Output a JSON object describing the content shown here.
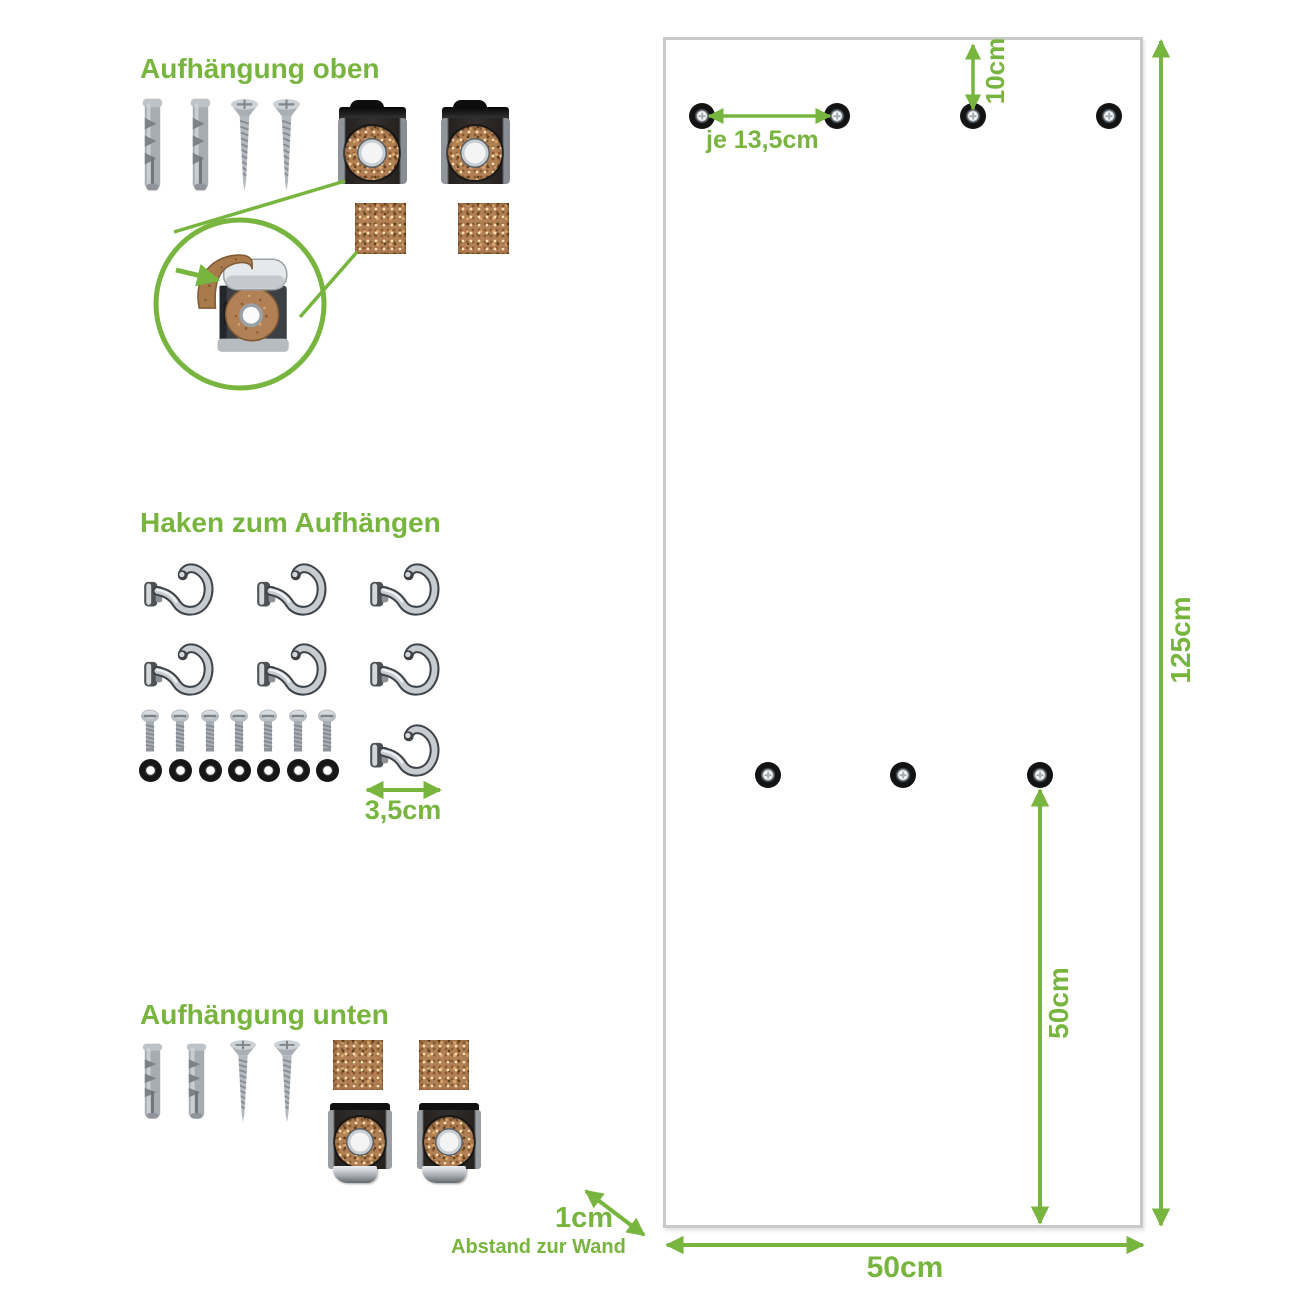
{
  "colors": {
    "accent_green": "#78b53f",
    "panel_border": "#c9c9c9",
    "cork": "#b28055",
    "metal_dark": "#2b2927",
    "chrome": "#c7ccd1"
  },
  "sections": {
    "hanging_top": {
      "title": "Aufhängung oben"
    },
    "hooks": {
      "title": "Haken zum Aufhängen",
      "hook_size": "3,5cm"
    },
    "hanging_bottom": {
      "title": "Aufhängung unten"
    }
  },
  "panel": {
    "dimensions": {
      "hole_spacing_top": "je 13,5cm",
      "top_edge_to_holes": "10cm",
      "panel_height": "125cm",
      "lower_holes_to_bottom": "50cm",
      "panel_width": "50cm",
      "wall_gap": "1cm",
      "wall_gap_caption": "Abstand zur Wand"
    }
  }
}
